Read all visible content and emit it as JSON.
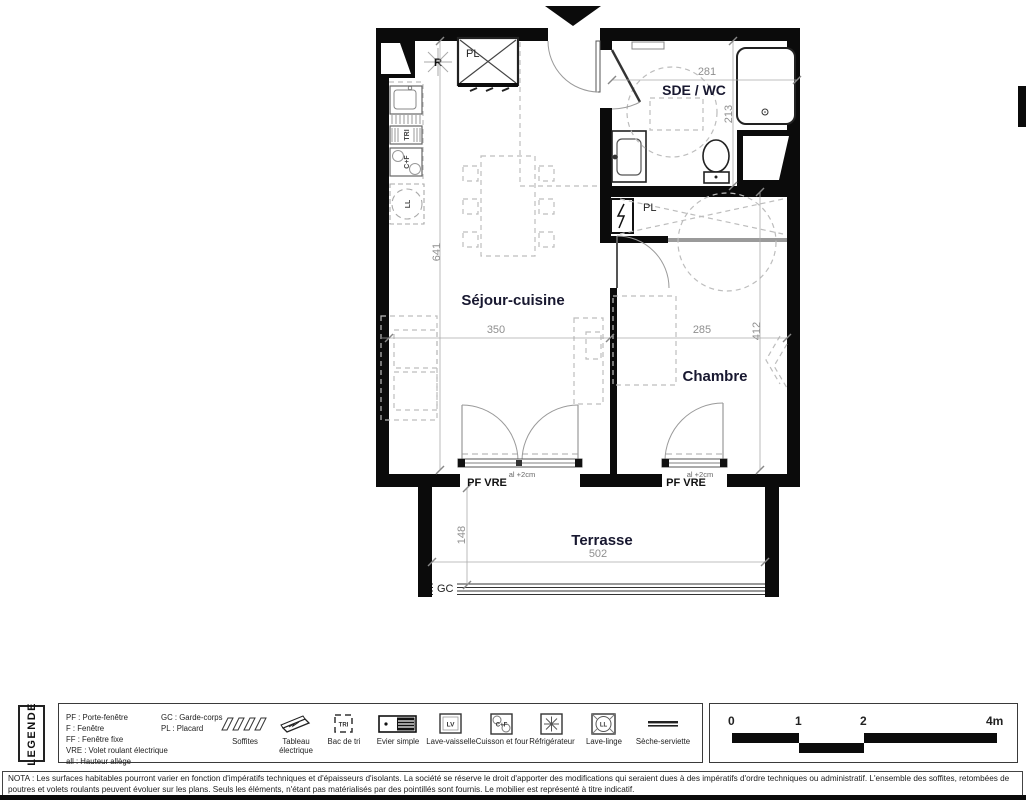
{
  "plan": {
    "room_labels": {
      "sde_wc": "SDE / WC",
      "sejour": "Séjour-cuisine",
      "chambre": "Chambre",
      "terrasse": "Terrasse"
    },
    "dimensions": {
      "sde_width": "281",
      "sde_depth": "213",
      "sejour_height": "641",
      "sejour_width": "350",
      "chambre_width": "285",
      "chambre_depth": "412",
      "terrasse_depth": "148",
      "terrasse_width": "502"
    },
    "annotations": {
      "placard_kitchen": "PL",
      "placard_chambre": "PL",
      "refrigerateur": "R",
      "bac_tri": "TRI",
      "cuisson_four": "C+F",
      "lave_linge": "LL",
      "garde_corps": "GC",
      "door_sejour": "PF  VRE",
      "door_chambre": "PF  VRE",
      "allege_sejour": "al +2cm",
      "allege_chambre": "al +2cm"
    }
  },
  "legend": {
    "title": "LEGENDE",
    "abbreviations": {
      "col1": [
        "PF : Porte-fenêtre",
        "F : Fenêtre",
        "FF : Fenêtre fixe",
        "VRE : Volet roulant électrique",
        "all : Hauteur allège"
      ],
      "col2": [
        "GC : Garde-corps",
        "PL : Placard"
      ]
    },
    "symbols": [
      {
        "label": "Soffites"
      },
      {
        "label": "Tableau électrique"
      },
      {
        "label": "Bac de tri",
        "glyph": "TRI"
      },
      {
        "label": "Evier simple"
      },
      {
        "label": "Lave-vaisselle",
        "glyph": "LV"
      },
      {
        "label": "Cuisson et four",
        "glyph": "C+F"
      },
      {
        "label": "Réfrigérateur"
      },
      {
        "label": "Lave-linge",
        "glyph": "LL"
      },
      {
        "label": "Sèche-serviette"
      }
    ],
    "scale": {
      "labels": [
        "0",
        "1",
        "2",
        "4m"
      ]
    }
  },
  "nota": {
    "line1": "NOTA : Les surfaces habitables pourront varier en fonction d'impératifs techniques et d'épaisseurs d'isolants. La société se réserve le droit d'apporter des modifications qui seraient dues à des impératifs d'ordre techniques ou administratif. L'ensemble",
    "line2": "des soffites, retombées de poutres et volets roulants peuvent évoluer sur les plans. Seuls les éléments, n'étant pas matérialisés par des pointillés sont fournis. Le mobilier est représenté à titre indicatif."
  }
}
